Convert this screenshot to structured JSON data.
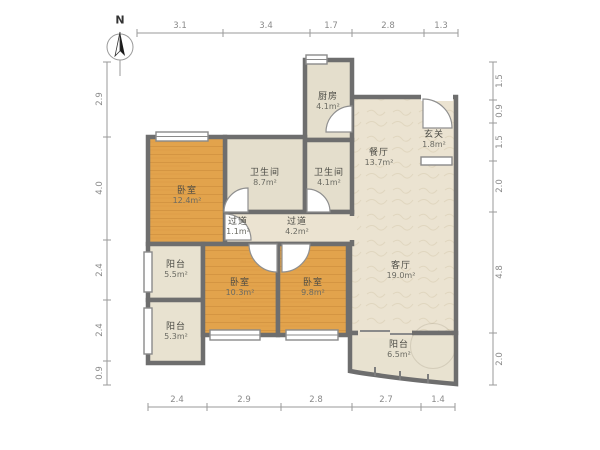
{
  "compass": {
    "label": "N"
  },
  "dims": {
    "top": [
      "3.1",
      "3.4",
      "1.7",
      "2.8",
      "1.3"
    ],
    "bottom": [
      "2.4",
      "2.9",
      "2.8",
      "2.7",
      "1.4"
    ],
    "left": [
      "2.9",
      "4.0",
      "2.4",
      "2.4",
      "0.9"
    ],
    "right": [
      "1.5",
      "0.9",
      "1.5",
      "2.0",
      "4.8",
      "2.0"
    ]
  },
  "rooms": [
    {
      "id": "bedroom-master",
      "name": "卧室",
      "area": "12.4m²"
    },
    {
      "id": "bathroom-large",
      "name": "卫生间",
      "area": "8.7m²"
    },
    {
      "id": "bathroom-small",
      "name": "卫生间",
      "area": "4.1m²"
    },
    {
      "id": "kitchen",
      "name": "厨房",
      "area": "4.1m²"
    },
    {
      "id": "dining-room",
      "name": "餐厅",
      "area": "13.7m²"
    },
    {
      "id": "foyer",
      "name": "玄关",
      "area": "1.8m²"
    },
    {
      "id": "hallway-small",
      "name": "过道",
      "area": "1.1m²"
    },
    {
      "id": "hallway",
      "name": "过道",
      "area": "4.2m²"
    },
    {
      "id": "balcony-west-upper",
      "name": "阳台",
      "area": "5.5m²"
    },
    {
      "id": "balcony-west-lower",
      "name": "阳台",
      "area": "5.3m²"
    },
    {
      "id": "bedroom-middle",
      "name": "卧室",
      "area": "10.3m²"
    },
    {
      "id": "bedroom-east",
      "name": "卧室",
      "area": "9.8m²"
    },
    {
      "id": "living-room",
      "name": "客厅",
      "area": "19.0m²"
    },
    {
      "id": "balcony-south",
      "name": "阳台",
      "area": "6.5m²"
    }
  ],
  "colors": {
    "wall": "#6e6e6e",
    "bedroom_fill": "#e2a34c",
    "room_fill": "#ebe3d1",
    "service_fill": "#e4decc",
    "dimension_line": "#9a9a9a"
  }
}
